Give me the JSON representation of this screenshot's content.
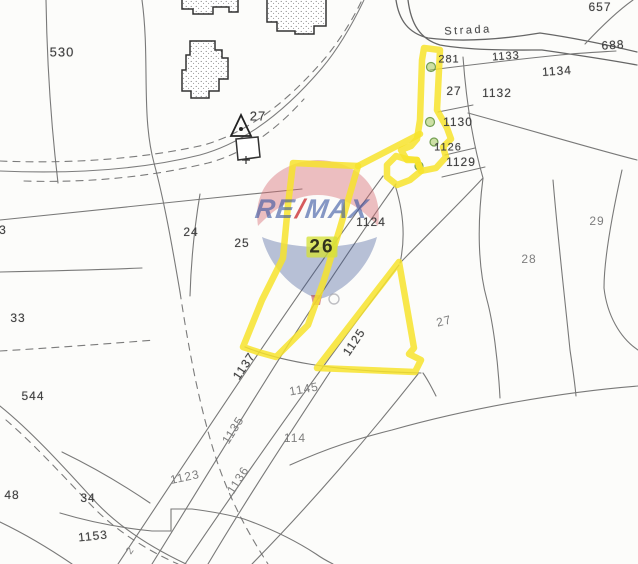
{
  "map": {
    "title": "cadastral parcel map with highlighted parcel",
    "highlighted_parcel": "26",
    "highlight_color": "#f7e32c",
    "road_label": "Strada",
    "labels": [
      {
        "text": "Strada",
        "x": 468,
        "y": 31,
        "rot": -3,
        "size": 11,
        "cls": "road"
      },
      {
        "text": "530",
        "x": 62,
        "y": 52,
        "rot": 0,
        "size": 13,
        "cls": ""
      },
      {
        "text": "657",
        "x": 600,
        "y": 7,
        "rot": 0,
        "size": 12,
        "cls": ""
      },
      {
        "text": "688",
        "x": 613,
        "y": 45,
        "rot": -4,
        "size": 12,
        "cls": ""
      },
      {
        "text": "281",
        "x": 449,
        "y": 60,
        "rot": 0,
        "size": 11,
        "cls": ""
      },
      {
        "text": "1133",
        "x": 506,
        "y": 57,
        "rot": -4,
        "size": 11,
        "cls": ""
      },
      {
        "text": "1134",
        "x": 557,
        "y": 71,
        "rot": -4,
        "size": 12,
        "cls": ""
      },
      {
        "text": "27",
        "x": 258,
        "y": 116,
        "rot": 0,
        "size": 13,
        "cls": ""
      },
      {
        "text": "27",
        "x": 454,
        "y": 91,
        "rot": 0,
        "size": 12,
        "cls": ""
      },
      {
        "text": "1132",
        "x": 497,
        "y": 93,
        "rot": 0,
        "size": 12,
        "cls": ""
      },
      {
        "text": "1130",
        "x": 458,
        "y": 122,
        "rot": 0,
        "size": 12,
        "cls": ""
      },
      {
        "text": "1126",
        "x": 448,
        "y": 148,
        "rot": 0,
        "size": 11,
        "cls": ""
      },
      {
        "text": "1129",
        "x": 461,
        "y": 162,
        "rot": 0,
        "size": 12,
        "cls": ""
      },
      {
        "text": "1124",
        "x": 371,
        "y": 222,
        "rot": 0,
        "size": 12,
        "cls": ""
      },
      {
        "text": "24",
        "x": 191,
        "y": 232,
        "rot": 0,
        "size": 12,
        "cls": ""
      },
      {
        "text": "25",
        "x": 242,
        "y": 243,
        "rot": 0,
        "size": 12,
        "cls": ""
      },
      {
        "text": "26",
        "x": 322,
        "y": 247,
        "rot": 0,
        "size": 19,
        "cls": "target"
      },
      {
        "text": "29",
        "x": 597,
        "y": 221,
        "rot": 0,
        "size": 12,
        "cls": "faint"
      },
      {
        "text": "28",
        "x": 529,
        "y": 259,
        "rot": 0,
        "size": 12,
        "cls": "faint"
      },
      {
        "text": "27",
        "x": 444,
        "y": 321,
        "rot": -14,
        "size": 12,
        "cls": "faint"
      },
      {
        "text": "3",
        "x": 3,
        "y": 230,
        "rot": 0,
        "size": 12,
        "cls": ""
      },
      {
        "text": "33",
        "x": 18,
        "y": 318,
        "rot": 0,
        "size": 12,
        "cls": ""
      },
      {
        "text": "544",
        "x": 33,
        "y": 396,
        "rot": 0,
        "size": 12,
        "cls": ""
      },
      {
        "text": "1125",
        "x": 354,
        "y": 342,
        "rot": -56,
        "size": 12,
        "cls": ""
      },
      {
        "text": "1137",
        "x": 244,
        "y": 366,
        "rot": -56,
        "size": 12,
        "cls": ""
      },
      {
        "text": "1145",
        "x": 304,
        "y": 389,
        "rot": -10,
        "size": 12,
        "cls": "faint"
      },
      {
        "text": "114",
        "x": 295,
        "y": 438,
        "rot": 0,
        "size": 12,
        "cls": "faint"
      },
      {
        "text": "1135",
        "x": 233,
        "y": 430,
        "rot": -58,
        "size": 12,
        "cls": "faint"
      },
      {
        "text": "1136",
        "x": 238,
        "y": 480,
        "rot": -58,
        "size": 12,
        "cls": "faint"
      },
      {
        "text": "1123",
        "x": 185,
        "y": 477,
        "rot": -12,
        "size": 12,
        "cls": "faint"
      },
      {
        "text": "48",
        "x": 12,
        "y": 495,
        "rot": 0,
        "size": 12,
        "cls": ""
      },
      {
        "text": "34",
        "x": 88,
        "y": 498,
        "rot": 0,
        "size": 12,
        "cls": ""
      },
      {
        "text": "1153",
        "x": 93,
        "y": 536,
        "rot": -6,
        "size": 12,
        "cls": ""
      },
      {
        "text": "2",
        "x": 131,
        "y": 551,
        "rot": -55,
        "size": 10,
        "cls": "faint"
      }
    ]
  },
  "watermark": {
    "brand": "RE/MAX",
    "re": "RE",
    "slash": "/",
    "max": "MAX",
    "text_color": "#3654a4",
    "slash_color": "#cd373a",
    "balloon_top_color": "#d6696f",
    "balloon_bottom_color": "#375091"
  }
}
